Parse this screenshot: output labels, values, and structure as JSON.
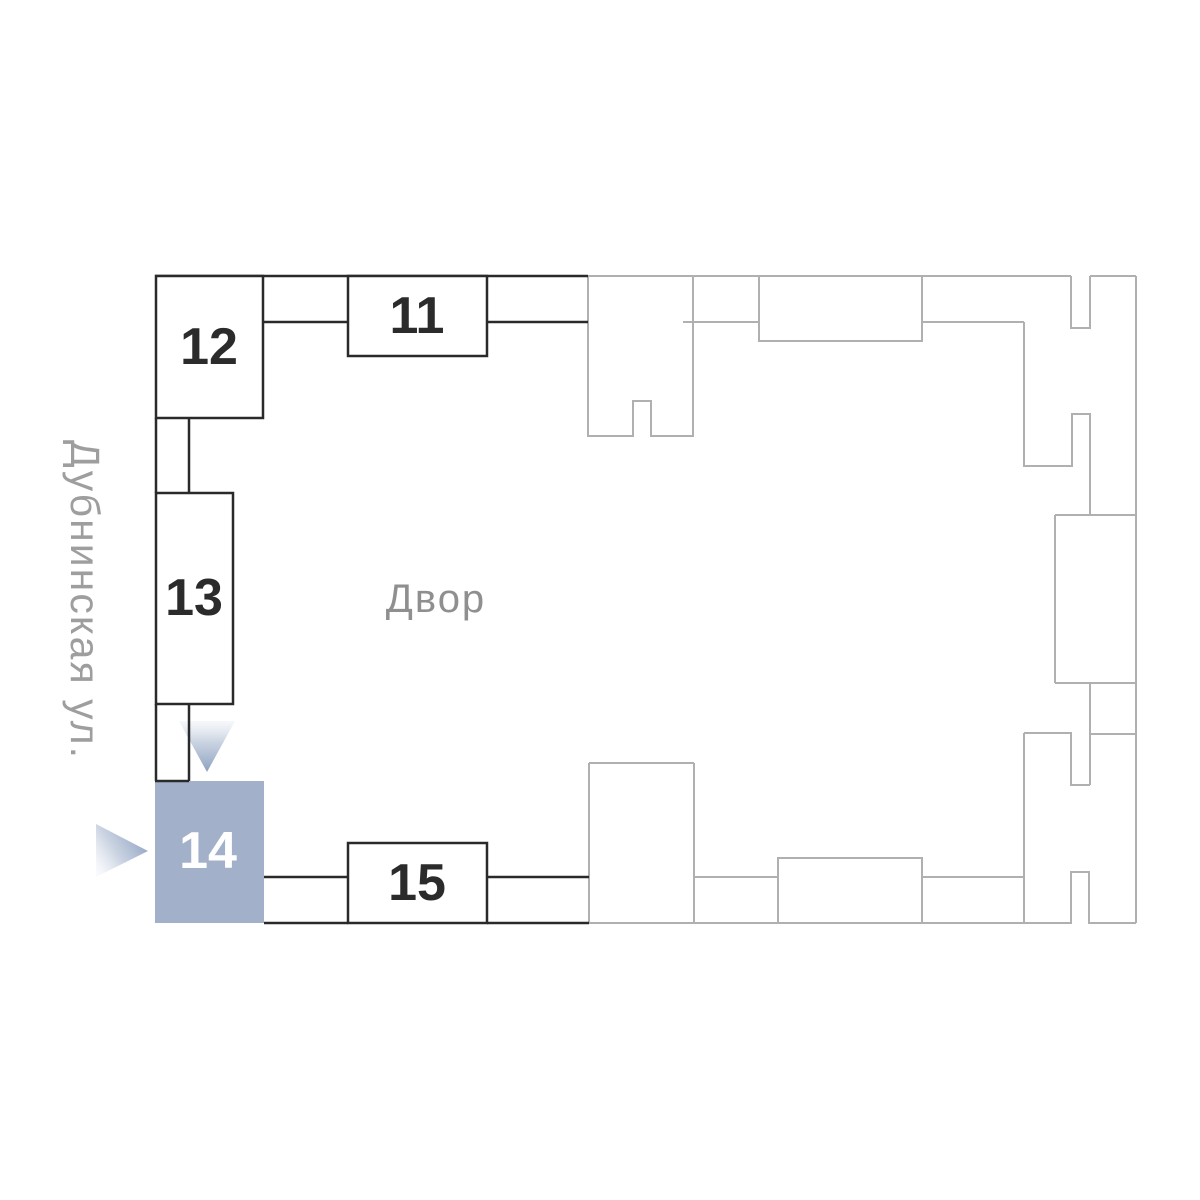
{
  "plan": {
    "title": "courtyard-site-plan",
    "street": {
      "label": "Дубнинская ул."
    },
    "courtyard": {
      "label": "Двор"
    },
    "selected_building": "14",
    "buildings": [
      {
        "id": "11",
        "label": "11",
        "selected": false
      },
      {
        "id": "12",
        "label": "12",
        "selected": false
      },
      {
        "id": "13",
        "label": "13",
        "selected": false
      },
      {
        "id": "14",
        "label": "14",
        "selected": true
      },
      {
        "id": "15",
        "label": "15",
        "selected": false
      }
    ],
    "colors": {
      "background": "#ffffff",
      "building_outline": "#2a2a2a",
      "building_number": "#2b2b2b",
      "selected_fill": "#a2b1c9",
      "selected_number": "#ffffff",
      "context_outline": "#b0b0b0",
      "courtyard_text": "#8f8f8f",
      "street_text": "#9e9e9e",
      "arrow_tip": "#8ca0bf"
    }
  }
}
